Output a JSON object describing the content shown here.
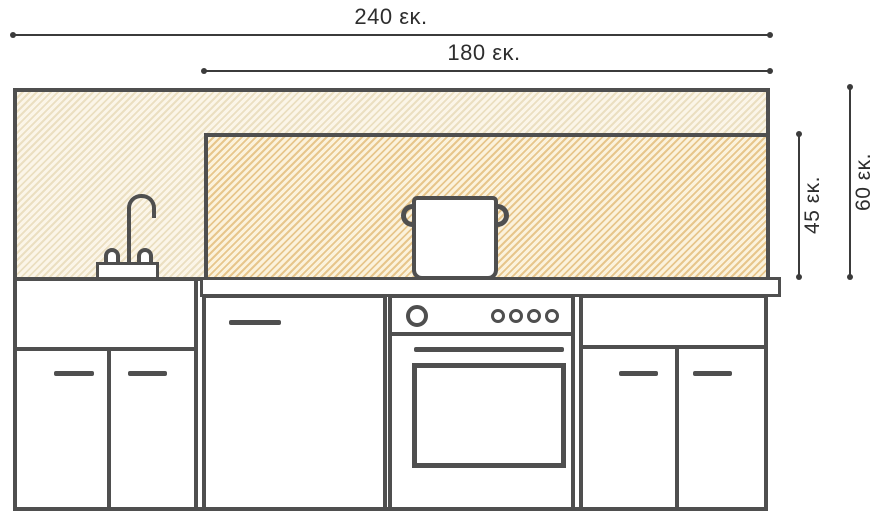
{
  "colors": {
    "line": "#4f4f4f",
    "dim": "#3b3b3b",
    "text": "#2e2e2e",
    "outer_hatch_bg": "#fbf5e8",
    "outer_hatch_line": "#ebdfc1",
    "inner_hatch_bg": "#fbf2dc",
    "inner_hatch_line": "#e7c68c"
  },
  "unit": "εκ.",
  "dimensions": {
    "total_width": {
      "label": "240 εκ.",
      "value": 240
    },
    "inner_width": {
      "label": "180 εκ.",
      "value": 180
    },
    "inner_height": {
      "label": "45 εκ.",
      "value": 45
    },
    "total_height": {
      "label": "60 εκ.",
      "value": 60
    }
  },
  "parts": [
    "backsplash-zone-240x60",
    "hob-zone-180x45",
    "faucet",
    "cooking-pot",
    "countertop",
    "sink-base-cabinet",
    "dishwasher-door",
    "oven",
    "right-base-cabinet"
  ]
}
